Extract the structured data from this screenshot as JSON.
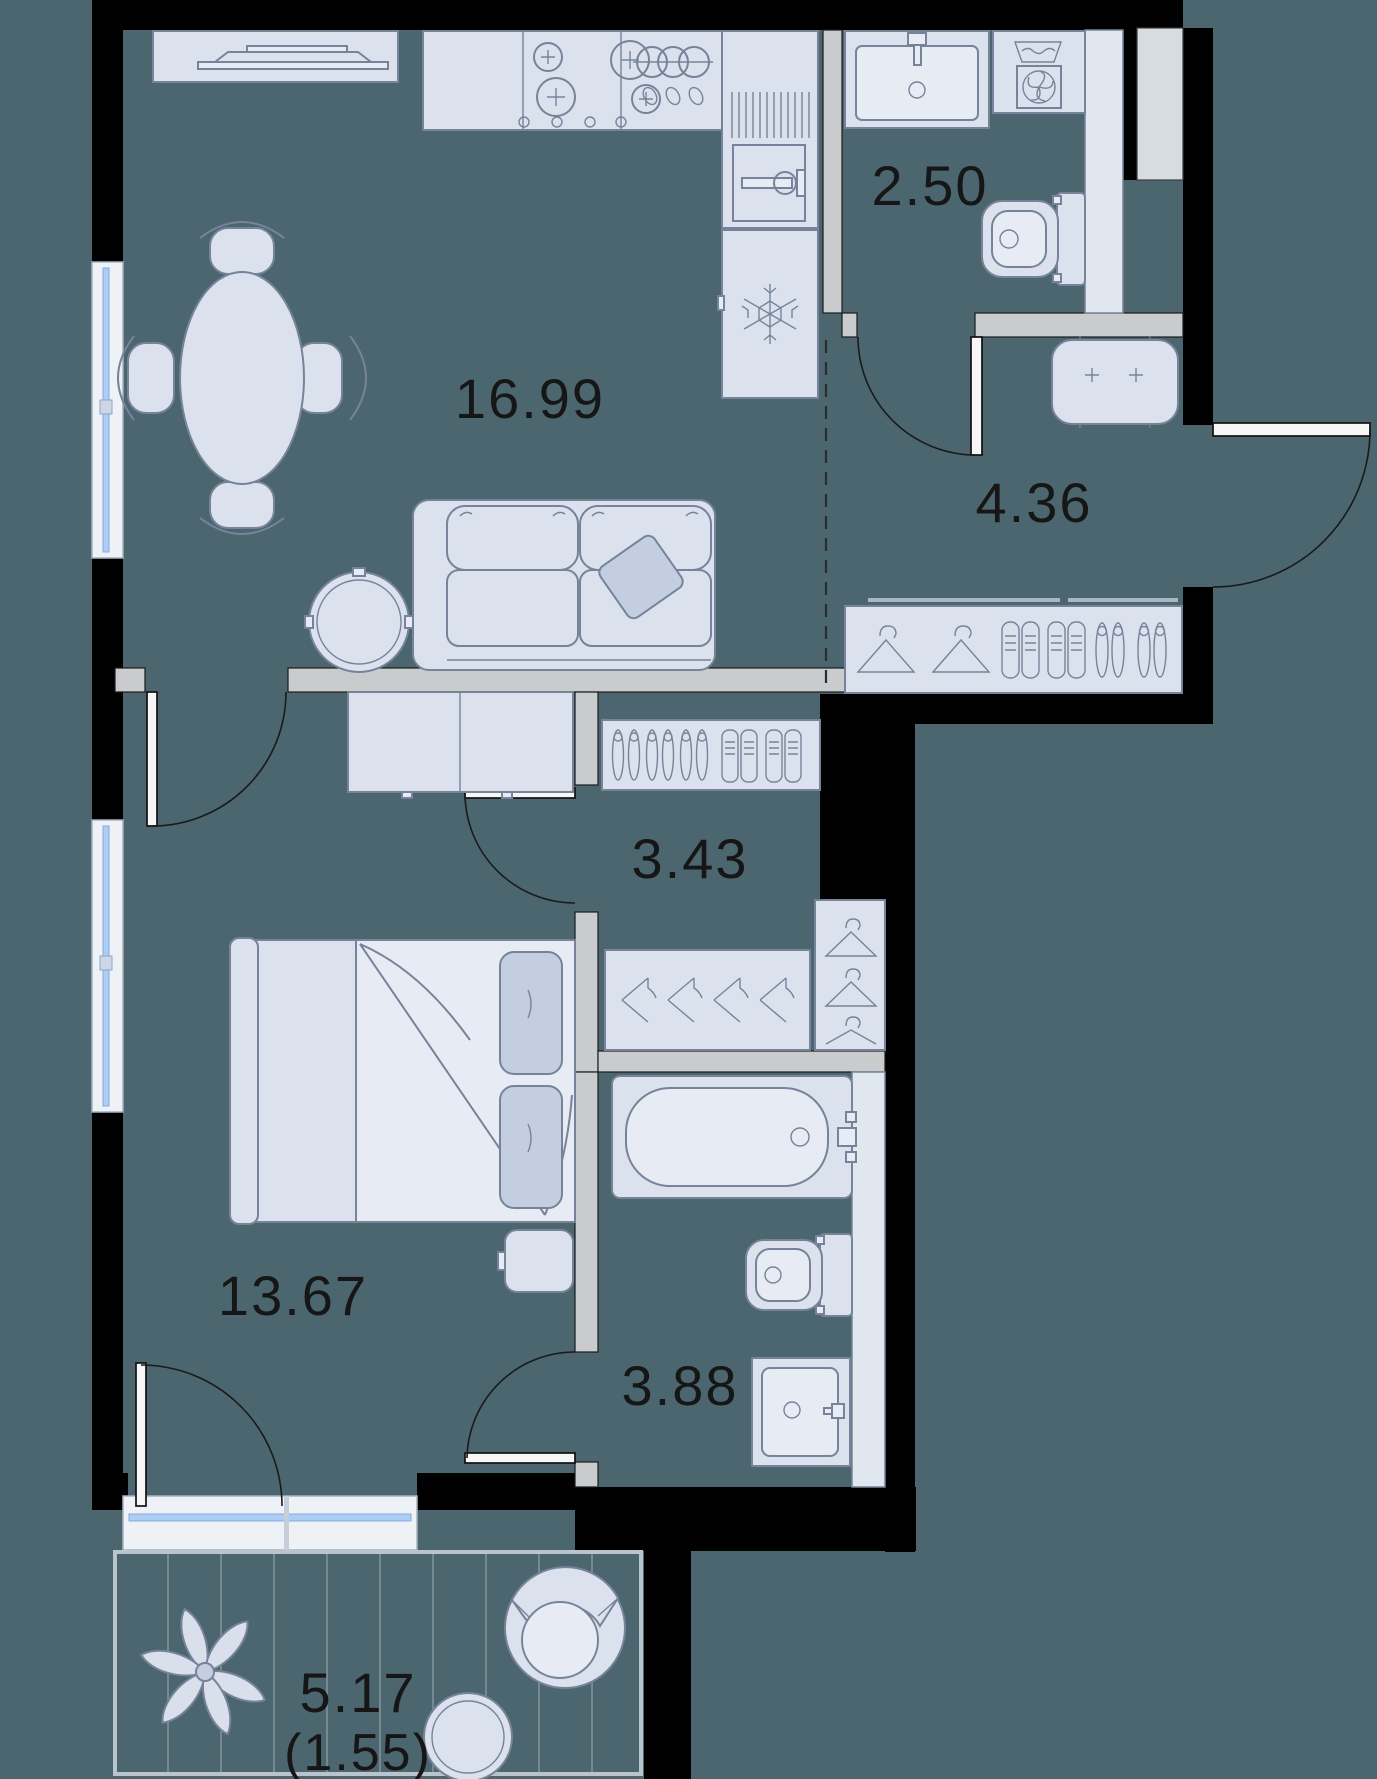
{
  "plan": {
    "type": "apartment-floor-plan",
    "rooms": {
      "living_kitchen": {
        "name": "living-kitchen",
        "area_label": "16.99"
      },
      "bathroom_guest": {
        "name": "guest-bathroom",
        "area_label": "2.50"
      },
      "hallway": {
        "name": "entrance-hallway",
        "area_label": "4.36"
      },
      "corridor": {
        "name": "inner-corridor",
        "area_label": "3.43"
      },
      "bedroom": {
        "name": "bedroom",
        "area_label": "13.67"
      },
      "bathroom_main": {
        "name": "main-bathroom",
        "area_label": "3.88"
      },
      "balcony": {
        "name": "balcony",
        "area_label": "5.17",
        "area_label_reduced": "(1.55)"
      }
    },
    "colors": {
      "background": "#4c666f",
      "walls": "#000000",
      "partitions": "#c9cbcd",
      "furniture_fill": "#dbe2ee",
      "furniture_stroke": "#76839a",
      "window_glass": "#aecdf5",
      "label_text": "#161616"
    },
    "icons": [
      "tv-stand",
      "dining-table",
      "sofa",
      "coffee-table",
      "stove-burners",
      "kitchen-sink",
      "oven",
      "fridge-snowflake",
      "bathroom-sink",
      "washing-machine",
      "toilet",
      "pouf",
      "hanger-front",
      "hanger-side",
      "shoes",
      "bed",
      "nightstand",
      "wardrobe",
      "bathtub",
      "plant",
      "armchair",
      "side-table",
      "window",
      "door-swing"
    ]
  }
}
